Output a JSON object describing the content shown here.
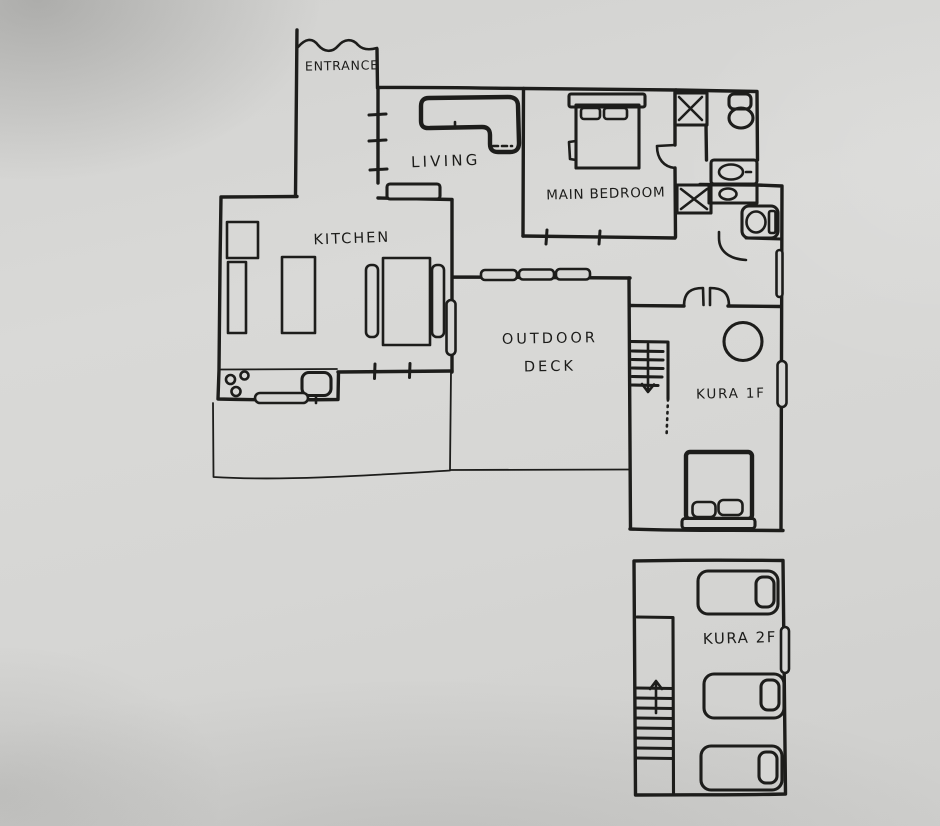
{
  "drawing": {
    "kind": "hand-drawn floor plan sketch",
    "ink_color": "#1d1d1b",
    "paper_color": "#d6d6d4"
  },
  "rooms": {
    "entrance": {
      "label": "ENTRANCE"
    },
    "living": {
      "label": "LIVING"
    },
    "main_bedroom": {
      "label": "MAIN BEDROOM"
    },
    "kitchen": {
      "label": "KITCHEN"
    },
    "outdoor_deck": {
      "line1": "OUTDOOR",
      "line2": "DECK"
    },
    "kura_1f": {
      "label": "KURA 1F"
    },
    "kura_2f": {
      "label": "KURA 2F"
    }
  },
  "furniture": {
    "living": [
      "l-shaped-sofa",
      "tv-stand"
    ],
    "main_bedroom": [
      "double-bed",
      "pillow",
      "pillow"
    ],
    "bathrooms": [
      "x-closet",
      "toilet",
      "washbasin",
      "washbasin",
      "x-closet",
      "toilet-side",
      "door-swing",
      "door-swing"
    ],
    "kitchen": [
      "fridge",
      "counter",
      "island",
      "dining-table",
      "chair",
      "chair",
      "stove",
      "sink",
      "tray"
    ],
    "outdoor_deck": [
      "sliding-door-3-panel",
      "sliding-door-marker",
      "annex-outline"
    ],
    "kura_1f": [
      "stairs-down",
      "round-table",
      "double-bed",
      "pillow",
      "pillow",
      "footboard",
      "double-door",
      "window",
      "window"
    ],
    "kura_2f": [
      "stairs-up",
      "single-bed",
      "single-bed",
      "single-bed",
      "window"
    ]
  }
}
